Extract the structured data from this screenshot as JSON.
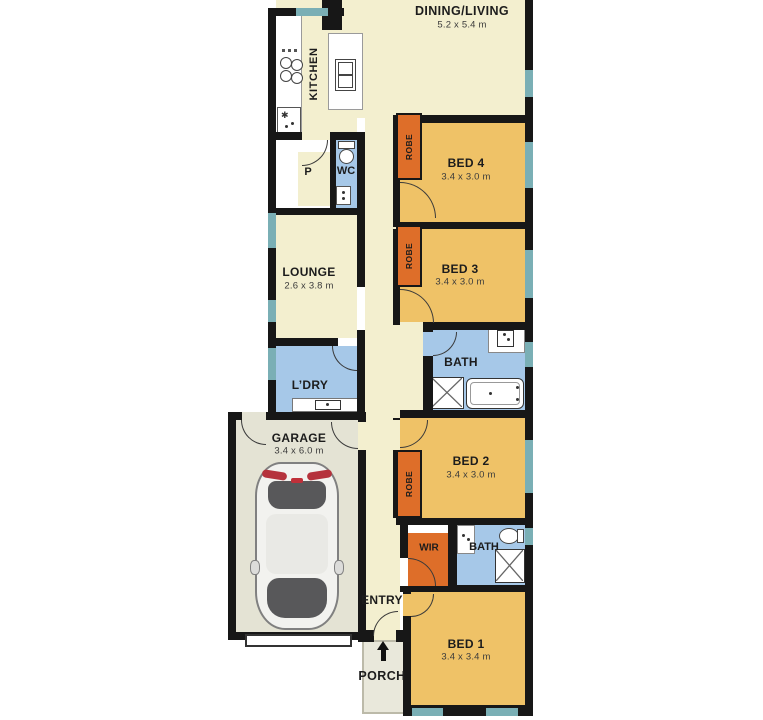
{
  "plan_type": "residential-floor-plan",
  "rooms": {
    "dining_living": {
      "name": "DINING/LIVING",
      "dims": "5.2 x 5.4 m"
    },
    "kitchen": {
      "name": "KITCHEN"
    },
    "pantry": {
      "name": "P"
    },
    "wc": {
      "name": "WC"
    },
    "bed4": {
      "name": "BED 4",
      "dims": "3.4 x 3.0 m"
    },
    "bed3": {
      "name": "BED 3",
      "dims": "3.4 x 3.0 m"
    },
    "lounge": {
      "name": "LOUNGE",
      "dims": "2.6 x 3.8 m"
    },
    "bath": {
      "name": "BATH"
    },
    "laundry": {
      "name": "L’DRY"
    },
    "garage": {
      "name": "GARAGE",
      "dims": "3.4 x 6.0 m"
    },
    "bed2": {
      "name": "BED 2",
      "dims": "3.4 x 3.0 m"
    },
    "wir": {
      "name": "WIR"
    },
    "ensuite": {
      "name": "BATH"
    },
    "entry": {
      "name": "ENTRY"
    },
    "bed1": {
      "name": "BED 1",
      "dims": "3.4 x 3.4 m"
    },
    "porch": {
      "name": "PORCH"
    }
  },
  "labels": {
    "robe": "ROBE"
  },
  "icons": {
    "entry_arrow": "arrow-up",
    "kitchen_sink": "✱"
  },
  "colors": {
    "wall": "#171717",
    "living_floor": "#f3efcf",
    "bedroom_floor": "#efc267",
    "wet_area_floor": "#a6c8e8",
    "garage_floor": "#e4e3d4",
    "robe_fill": "#de6e29",
    "window": "#7aafb5",
    "background": "#ffffff"
  }
}
